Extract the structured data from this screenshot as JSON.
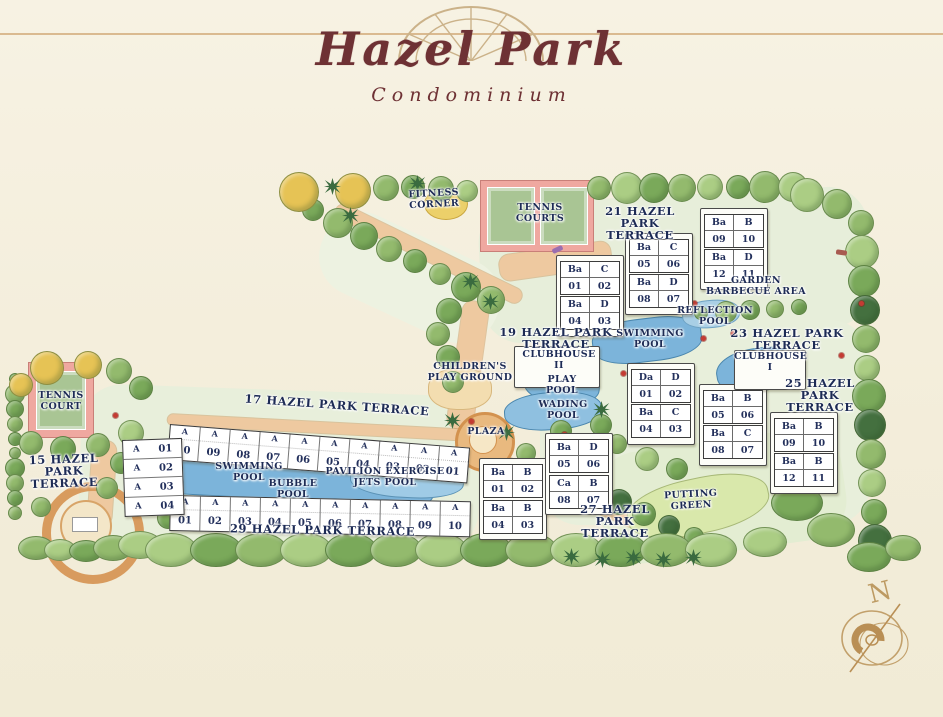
{
  "title": {
    "name": "Hazel Park",
    "type": "Condominium"
  },
  "compass_label": "N",
  "colors": {
    "paper": "#f3edda",
    "title_text": "#6e3134",
    "ornament": "#cbb289",
    "label_text": "#1d2b55",
    "tree_green": "#93ba6d",
    "tree_yellow": "#e6c355",
    "pool_blue": "#7cb4da",
    "court_pink": "#efa8a0",
    "court_green": "#a9c594",
    "path_orange": "#eec9a0",
    "putting_green": "#d9e8ab"
  },
  "map": {
    "terrace_labels": [
      {
        "text": "21 HAZEL\nPARK\nTERRACE",
        "x": 588,
        "y": 205,
        "w": 104,
        "rot": 0
      },
      {
        "text": "19 HAZEL PARK\nTERRACE",
        "x": 482,
        "y": 326,
        "w": 148,
        "rot": 0
      },
      {
        "text": "23 HAZEL PARK\nTERRACE",
        "x": 712,
        "y": 327,
        "w": 150,
        "rot": 0
      },
      {
        "text": "25 HAZEL\nPARK\nTERRACE",
        "x": 772,
        "y": 377,
        "w": 96,
        "rot": 0
      },
      {
        "text": "27 HAZEL\nPARK\nTERRACE",
        "x": 566,
        "y": 503,
        "w": 98,
        "rot": 0
      },
      {
        "text": "17 HAZEL PARK TERRACE",
        "x": 212,
        "y": 399,
        "w": 250,
        "rot": 4
      },
      {
        "text": "29 HAZEL PARK TERRACE",
        "x": 200,
        "y": 524,
        "w": 245,
        "rot": 1
      },
      {
        "text": "15 HAZEL\nPARK\nTERRACE",
        "x": 14,
        "y": 453,
        "w": 100,
        "rot": -2
      }
    ],
    "amenity_labels": [
      {
        "text": "FITNESS\nCORNER",
        "x": 396,
        "y": 189,
        "w": 76,
        "rot": -3
      },
      {
        "text": "TENNIS\nCOURTS",
        "x": 500,
        "y": 203,
        "w": 80,
        "rot": 0
      },
      {
        "text": "TENNIS\nCOURT",
        "x": 26,
        "y": 391,
        "w": 70,
        "rot": 0
      },
      {
        "text": "GARDEN\nBARBECUE AREA",
        "x": 694,
        "y": 276,
        "w": 124,
        "rot": 0
      },
      {
        "text": "REFLECTION\nPOOL",
        "x": 666,
        "y": 306,
        "w": 98,
        "rot": 0
      },
      {
        "text": "SWIMMING\nPOOL",
        "x": 604,
        "y": 329,
        "w": 92,
        "rot": 0
      },
      {
        "text": "CLUBHOUSE\nII",
        "x": 516,
        "y": 350,
        "w": 86,
        "rot": 0
      },
      {
        "text": "CLUBHOUSE\nI",
        "x": 734,
        "y": 352,
        "w": 72,
        "rot": 0
      },
      {
        "text": "CHILDREN'S\nPLAY GROUND",
        "x": 420,
        "y": 362,
        "w": 100,
        "rot": 0
      },
      {
        "text": "PLAY\nPOOL",
        "x": 530,
        "y": 375,
        "w": 64,
        "rot": 0
      },
      {
        "text": "WADING\nPOOL",
        "x": 522,
        "y": 400,
        "w": 82,
        "rot": 0
      },
      {
        "text": "PLAZA",
        "x": 458,
        "y": 427,
        "w": 56,
        "rot": 0
      },
      {
        "text": "SWIMMING\nPOOL",
        "x": 202,
        "y": 462,
        "w": 94,
        "rot": 0
      },
      {
        "text": "BUBBLE\nPOOL",
        "x": 258,
        "y": 479,
        "w": 70,
        "rot": 0
      },
      {
        "text": "PAVILION EXERCISE\nJETS POOL",
        "x": 314,
        "y": 467,
        "w": 142,
        "rot": 0
      },
      {
        "text": "PUTTING\nGREEN",
        "x": 652,
        "y": 490,
        "w": 78,
        "rot": -3
      }
    ],
    "unit_blocks": [
      {
        "x": 704,
        "y": 214,
        "cells": [
          [
            "Ba",
            "B"
          ],
          [
            "09",
            "10"
          ]
        ]
      },
      {
        "x": 704,
        "y": 249,
        "cells": [
          [
            "Ba",
            "D"
          ],
          [
            "12",
            "11"
          ]
        ]
      },
      {
        "x": 629,
        "y": 239,
        "cells": [
          [
            "Ba",
            "C"
          ],
          [
            "05",
            "06"
          ]
        ]
      },
      {
        "x": 629,
        "y": 274,
        "cells": [
          [
            "Ba",
            "D"
          ],
          [
            "08",
            "07"
          ]
        ]
      },
      {
        "x": 560,
        "y": 261,
        "cells": [
          [
            "Ba",
            "C"
          ],
          [
            "01",
            "02"
          ]
        ]
      },
      {
        "x": 560,
        "y": 296,
        "cells": [
          [
            "Ba",
            "D"
          ],
          [
            "04",
            "03"
          ]
        ]
      },
      {
        "x": 631,
        "y": 369,
        "cells": [
          [
            "Da",
            "D"
          ],
          [
            "01",
            "02"
          ]
        ]
      },
      {
        "x": 631,
        "y": 404,
        "cells": [
          [
            "Ba",
            "C"
          ],
          [
            "04",
            "03"
          ]
        ]
      },
      {
        "x": 703,
        "y": 390,
        "cells": [
          [
            "Ba",
            "B"
          ],
          [
            "05",
            "06"
          ]
        ]
      },
      {
        "x": 703,
        "y": 425,
        "cells": [
          [
            "Ba",
            "C"
          ],
          [
            "08",
            "07"
          ]
        ]
      },
      {
        "x": 774,
        "y": 418,
        "cells": [
          [
            "Ba",
            "B"
          ],
          [
            "09",
            "10"
          ]
        ]
      },
      {
        "x": 774,
        "y": 453,
        "cells": [
          [
            "Ba",
            "B"
          ],
          [
            "12",
            "11"
          ]
        ]
      },
      {
        "x": 549,
        "y": 439,
        "cells": [
          [
            "Ba",
            "D"
          ],
          [
            "05",
            "06"
          ]
        ]
      },
      {
        "x": 483,
        "y": 464,
        "cells": [
          [
            "Ba",
            "B"
          ],
          [
            "01",
            "02"
          ]
        ]
      },
      {
        "x": 549,
        "y": 475,
        "cells": [
          [
            "Ca",
            "B"
          ],
          [
            "08",
            "07"
          ]
        ]
      },
      {
        "x": 483,
        "y": 500,
        "cells": [
          [
            "Ba",
            "B"
          ],
          [
            "04",
            "03"
          ]
        ]
      }
    ],
    "row_buildings": [
      {
        "name": "17-hazel-park-terrace",
        "letter": "A",
        "dir": "h",
        "x": 170,
        "y": 424,
        "rot": 4.5,
        "numbers": [
          "10",
          "09",
          "08",
          "07",
          "06",
          "05",
          "04",
          "03",
          "02",
          "01"
        ]
      },
      {
        "name": "29-hazel-park-terrace",
        "letter": "A",
        "dir": "h",
        "x": 170,
        "y": 495,
        "rot": 1.2,
        "numbers": [
          "01",
          "02",
          "03",
          "04",
          "05",
          "06",
          "07",
          "08",
          "09",
          "10"
        ]
      },
      {
        "name": "15-hazel-park-terrace",
        "letter": "A",
        "dir": "v",
        "x": 122,
        "y": 440,
        "rot": -2,
        "numbers": [
          "01",
          "02",
          "03",
          "04"
        ]
      }
    ]
  }
}
